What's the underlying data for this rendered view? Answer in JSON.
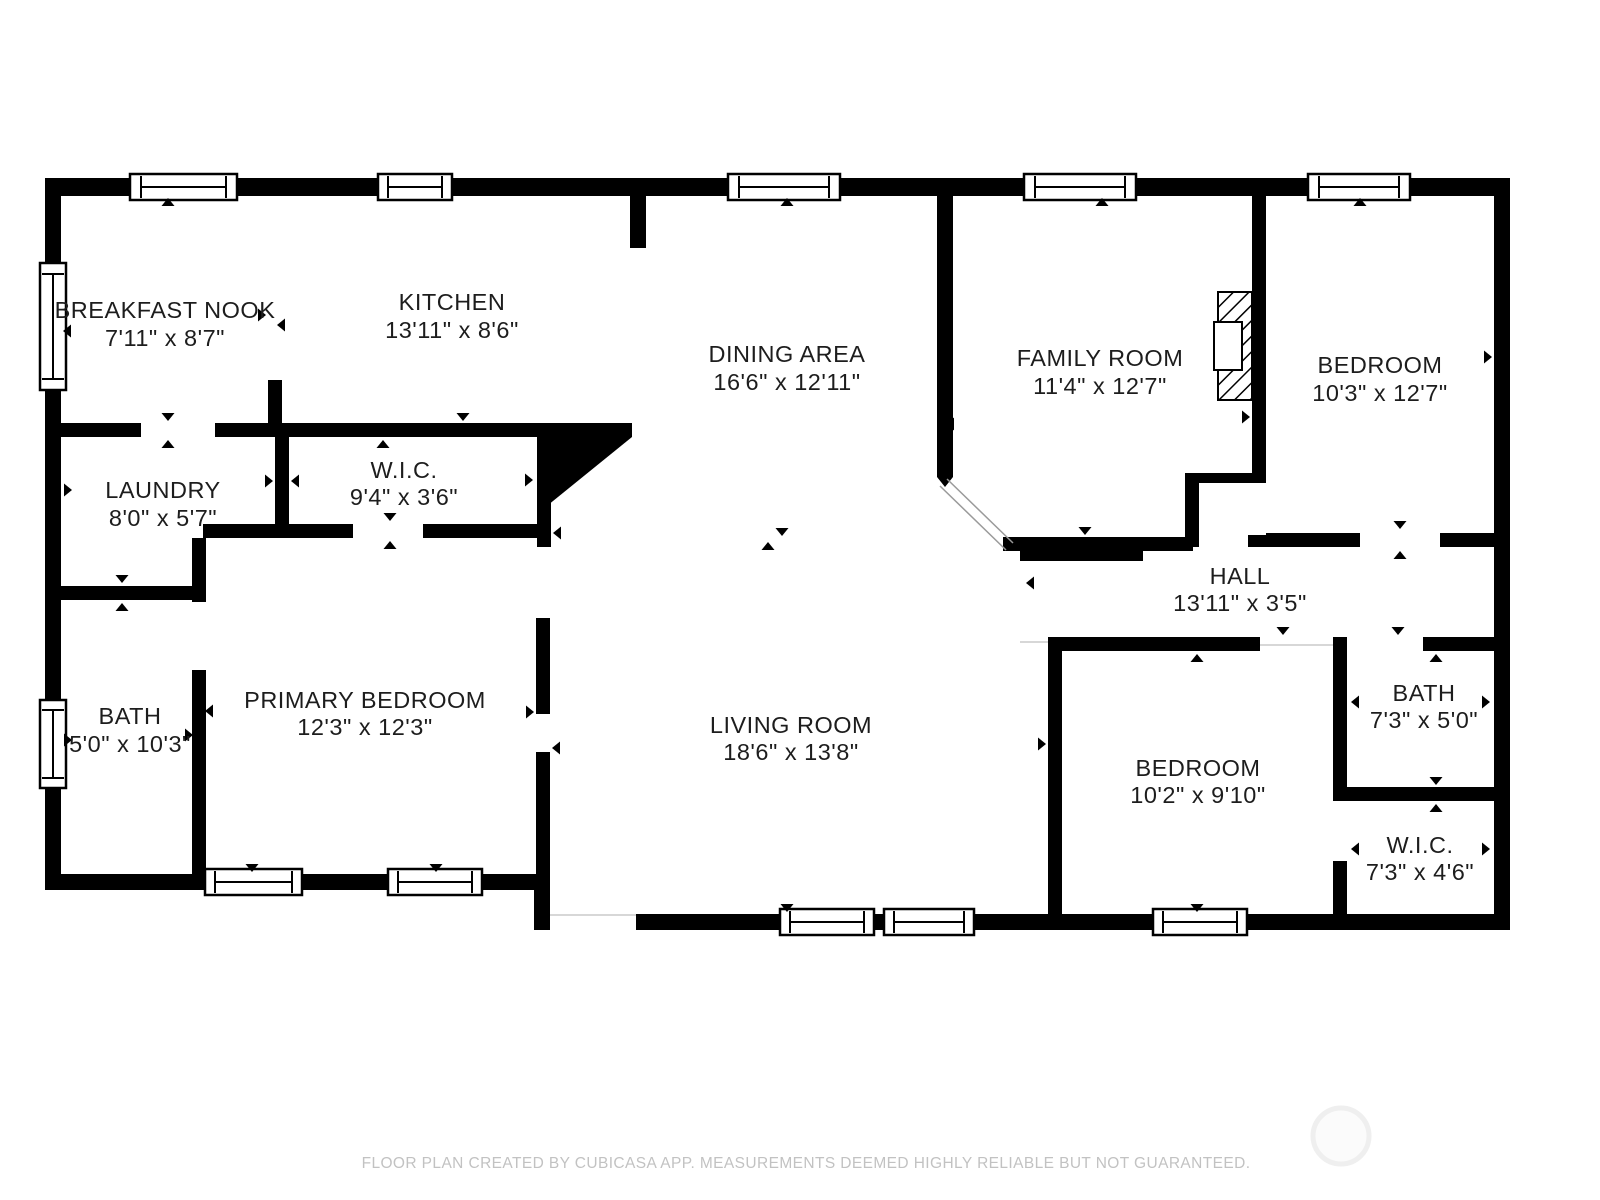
{
  "title": "Floor plan",
  "palette": {
    "wall": "#000000",
    "floor": "#ffffff",
    "label": "#1d1d1d",
    "footer_text": "#c2c2c2",
    "watermark": "#efefef"
  },
  "rooms": [
    {
      "id": "breakfast-nook",
      "name": "BREAKFAST NOOK",
      "dims": "7'11\" x 8'7\""
    },
    {
      "id": "kitchen",
      "name": "KITCHEN",
      "dims": "13'11\" x 8'6\""
    },
    {
      "id": "dining-area",
      "name": "DINING AREA",
      "dims": "16'6\" x 12'11\""
    },
    {
      "id": "family-room",
      "name": "FAMILY ROOM",
      "dims": "11'4\" x 12'7\""
    },
    {
      "id": "bedroom-top-right",
      "name": "BEDROOM",
      "dims": "10'3\" x 12'7\""
    },
    {
      "id": "laundry",
      "name": "LAUNDRY",
      "dims": "8'0\" x 5'7\""
    },
    {
      "id": "wic-top",
      "name": "W.I.C.",
      "dims": "9'4\" x 3'6\""
    },
    {
      "id": "hall",
      "name": "HALL",
      "dims": "13'11\" x 3'5\""
    },
    {
      "id": "bath-left",
      "name": "BATH",
      "dims": "5'0\" x 10'3\""
    },
    {
      "id": "primary-bedroom",
      "name": "PRIMARY BEDROOM",
      "dims": "12'3\" x 12'3\""
    },
    {
      "id": "living-room",
      "name": "LIVING ROOM",
      "dims": "18'6\" x 13'8\""
    },
    {
      "id": "bedroom-bottom",
      "name": "BEDROOM",
      "dims": "10'2\" x 9'10\""
    },
    {
      "id": "bath-right",
      "name": "BATH",
      "dims": "7'3\" x 5'0\""
    },
    {
      "id": "wic-bottom",
      "name": "W.I.C.",
      "dims": "7'3\" x 4'6\""
    }
  ],
  "footer": {
    "text": "FLOOR PLAN CREATED BY CUBICASA APP. MEASUREMENTS DEEMED HIGHLY RELIABLE BUT NOT GUARANTEED."
  }
}
